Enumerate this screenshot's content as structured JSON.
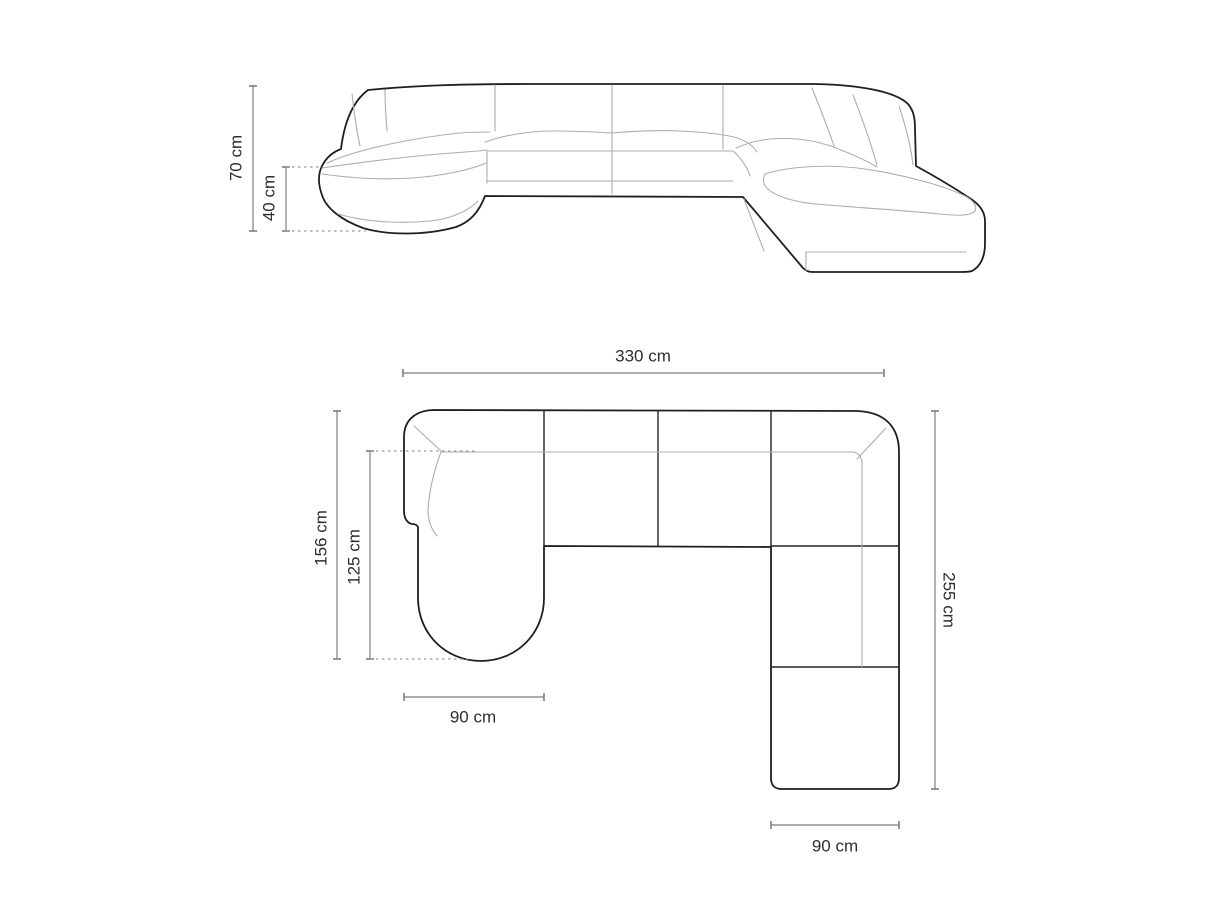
{
  "diagram": {
    "subject": "panoramic corner sofa dimension drawing",
    "front_view": {
      "height_label": "70 cm",
      "seat_height_label": "40 cm"
    },
    "top_view": {
      "width_label": "330 cm",
      "left_depth_label": "156 cm",
      "chaise_length_label": "125 cm",
      "chaise_width_label": "90 cm",
      "right_depth_label": "255 cm",
      "end_module_width_label": "90 cm"
    },
    "colors": {
      "outline": "#1f1f1f",
      "seam": "#242424",
      "light": "#adadad",
      "dim": "#7e7e7e",
      "dot": "#9a9a9a",
      "text": "#2e2e2e",
      "bg": "#ffffff"
    }
  }
}
